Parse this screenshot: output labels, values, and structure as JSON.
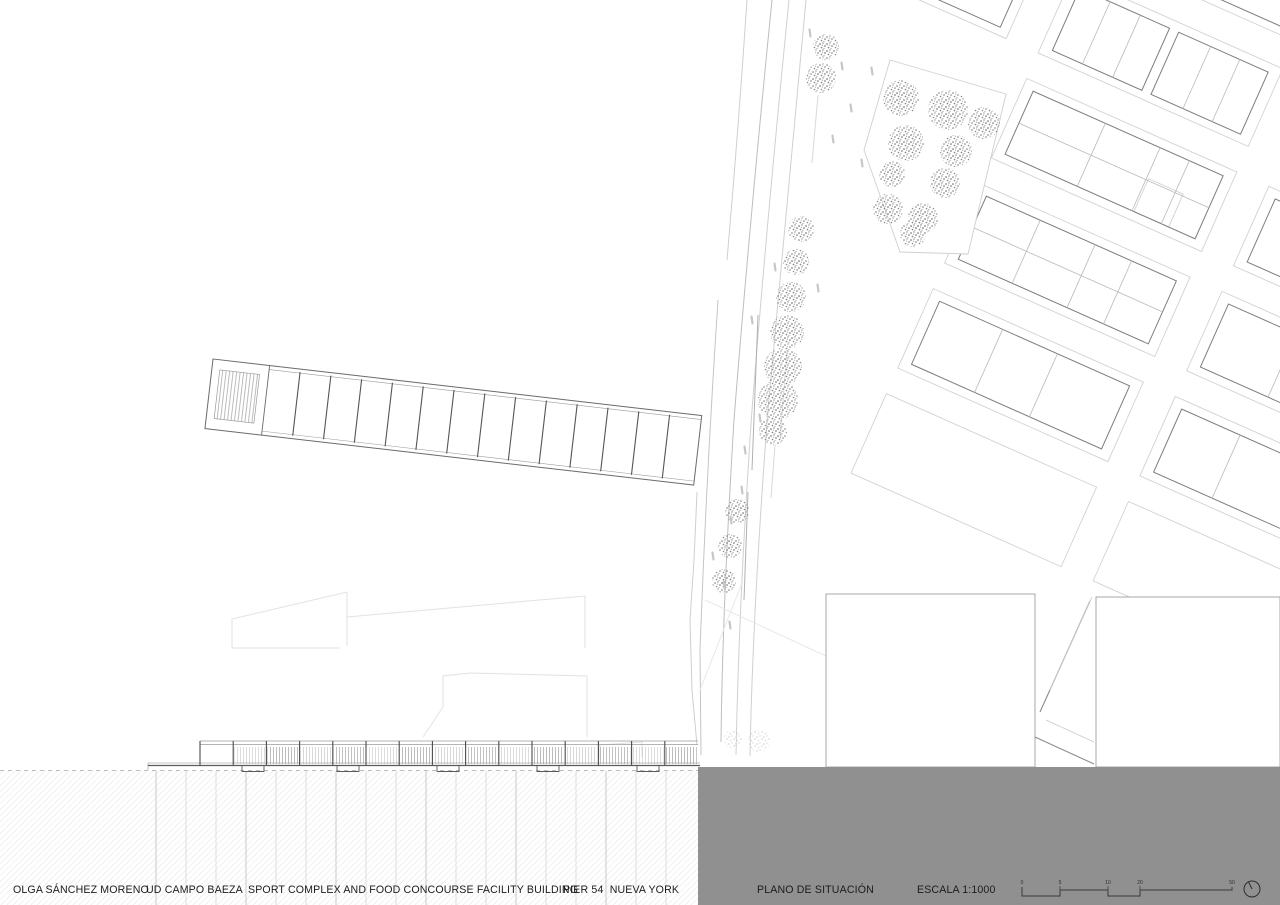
{
  "title_block": {
    "author": "OLGA SÁNCHEZ MORENO",
    "studio": "UD CAMPO BAEZA",
    "project": "SPORT COMPLEX AND FOOD CONCOURSE FACILITY BUILDING",
    "location": "PIER 54  NUEVA YORK"
  },
  "drawing_info": {
    "title": "PLANO DE SITUACIÓN",
    "scale": "ESCALA 1:1000",
    "scale_bar_ticks": [
      "0",
      "5",
      "10",
      "20",
      "50"
    ]
  },
  "colors": {
    "water": "#909090",
    "ink": "#1c1c1c"
  }
}
